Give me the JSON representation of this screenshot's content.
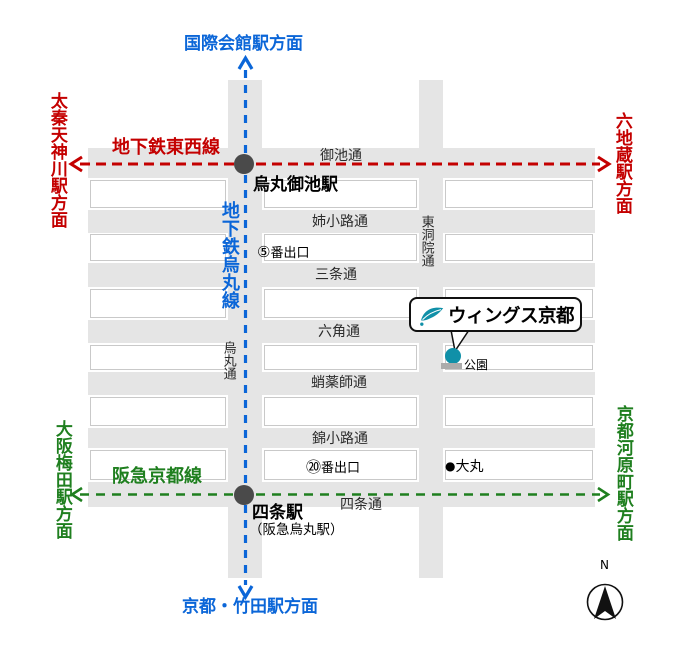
{
  "colors": {
    "tozai_red": "#c40000",
    "karasuma_blue": "#0b66d8",
    "hankyu_green": "#1f7f1f",
    "wings_teal": "#1090a8",
    "street_gray": "#e5e5e5",
    "block_border": "#c9c9c9",
    "station_dot": "#4a4a4a",
    "label_dark": "#2b2b2b"
  },
  "directions": {
    "north": "国際会館駅方面",
    "south": "京都・竹田駅方面",
    "tozai_west": "太秦天神川駅方面",
    "tozai_east": "六地蔵駅方面",
    "hankyu_west": "大阪梅田駅方面",
    "hankyu_east": "京都河原町駅方面"
  },
  "rail_lines": {
    "tozai": "地下鉄東西線",
    "karasuma": "地下鉄烏丸線",
    "hankyu": "阪急京都線"
  },
  "stations": {
    "karasuma_oike": "烏丸御池駅",
    "shijo": "四条駅",
    "shijo_alt": "（阪急烏丸駅）"
  },
  "streets": {
    "oike": "御池通",
    "aneyakoji": "姉小路通",
    "sanjo": "三条通",
    "rokkaku": "六角通",
    "takoyakushi": "蛸薬師通",
    "nishikikoji": "錦小路通",
    "shijo": "四条通",
    "karasuma": "烏丸通",
    "higashinotoin": "東洞院通"
  },
  "exits": {
    "exit5": {
      "num": "⑤",
      "label": "番出口"
    },
    "exit20": {
      "num": "⑳",
      "label": "番出口"
    }
  },
  "landmarks": {
    "wings_kyoto": "ウィングス京都",
    "park": "公園",
    "daimaru": "大丸",
    "daimaru_marker": "●"
  },
  "compass": {
    "north": "N"
  }
}
